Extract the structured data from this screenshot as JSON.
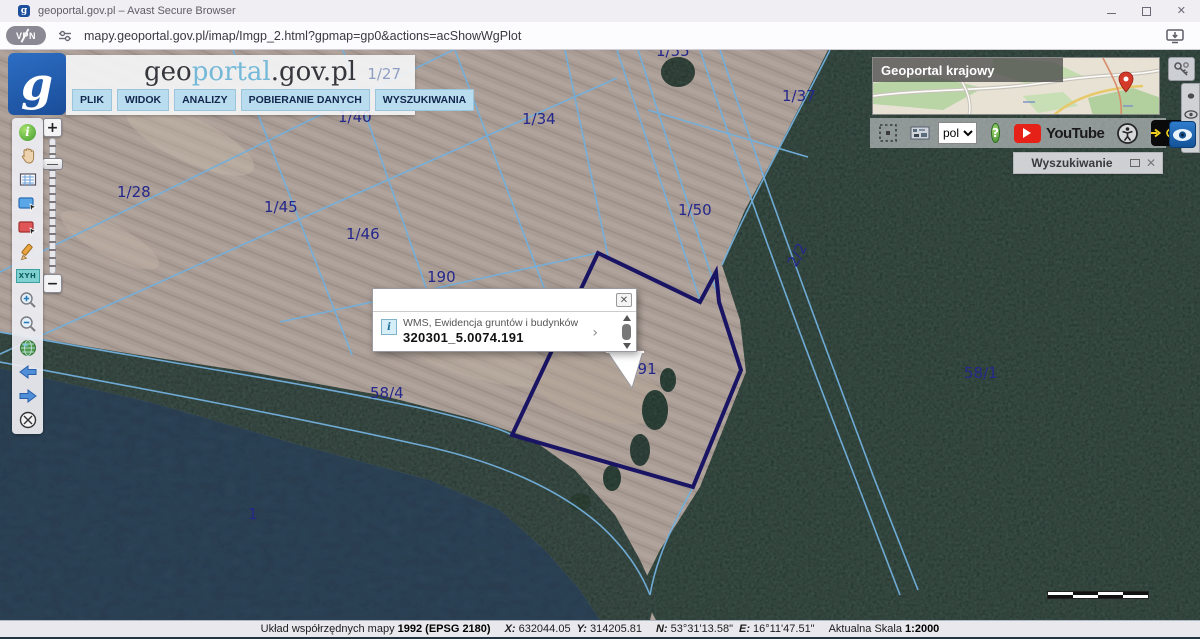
{
  "browser": {
    "tab_title": "geoportal.gov.pl – Avast Secure Browser",
    "url": "mapy.geoportal.gov.pl/imap/Imgp_2.html?gpmap=gp0&actions=acShowWgPlot",
    "vpn_label": "VPN"
  },
  "header": {
    "logo_letter": "g",
    "wordmark": {
      "geo": "geo",
      "portal": "portal",
      "suffix": ".gov.pl"
    },
    "overlay_parcel_label": "1/27",
    "menu": [
      "PLIK",
      "WIDOK",
      "ANALIZY",
      "POBIERANIE DANYCH",
      "WYSZUKIWANIA"
    ]
  },
  "toolbar_left": {
    "icons": [
      "info",
      "pan-hand",
      "print-map",
      "select-rectangle",
      "clear-selection-rectangle",
      "draw-pencil",
      "xyh-coordinates",
      "zoom-in",
      "zoom-out",
      "full-extent",
      "previous-view",
      "next-view",
      "clear-map"
    ],
    "xyh_label": "XYH"
  },
  "zoom_slider": {
    "plus": "+",
    "minus": "−"
  },
  "minimap": {
    "title": "Geoportal krajowy"
  },
  "top_toolbar": {
    "language_value": "pol",
    "help_label": "?",
    "youtube_label": "YouTube"
  },
  "search_panel": {
    "title": "Wyszukiwanie",
    "close_label": "✕"
  },
  "popup": {
    "line1": "WMS, Ewidencja gruntów i budynków",
    "line2": "320301_5.0074.191",
    "chevron": "›",
    "close_label": "✕"
  },
  "map": {
    "labels": [
      {
        "text": "1/55",
        "x": 656,
        "y": 6
      },
      {
        "text": "1/40",
        "x": 338,
        "y": 72
      },
      {
        "text": "1/34",
        "x": 522,
        "y": 74
      },
      {
        "text": "1/37",
        "x": 782,
        "y": 51
      },
      {
        "text": "1/28",
        "x": 117,
        "y": 147
      },
      {
        "text": "1/45",
        "x": 264,
        "y": 162
      },
      {
        "text": "1/46",
        "x": 346,
        "y": 189
      },
      {
        "text": "1/50",
        "x": 678,
        "y": 165
      },
      {
        "text": "2/2",
        "x": 796,
        "y": 218,
        "rotate": -62
      },
      {
        "text": "190",
        "x": 427,
        "y": 232
      },
      {
        "text": "191",
        "x": 628,
        "y": 324
      },
      {
        "text": "58/4",
        "x": 370,
        "y": 348
      },
      {
        "text": "58/1",
        "x": 964,
        "y": 328
      },
      {
        "text": "1",
        "x": 248,
        "y": 469
      }
    ]
  },
  "status_bar": {
    "prefix": "Układ współrzędnych mapy",
    "crs": "1992 (EPSG 2180)",
    "x_label": "X:",
    "x": "632044.05",
    "y_label": "Y:",
    "y": "314205.81",
    "n_label": "N:",
    "n": "53°31'13.58\"",
    "e_label": "E:",
    "e": "16°11'47.51\"",
    "scale_label": "Aktualna Skala",
    "scale": "1:2000"
  }
}
